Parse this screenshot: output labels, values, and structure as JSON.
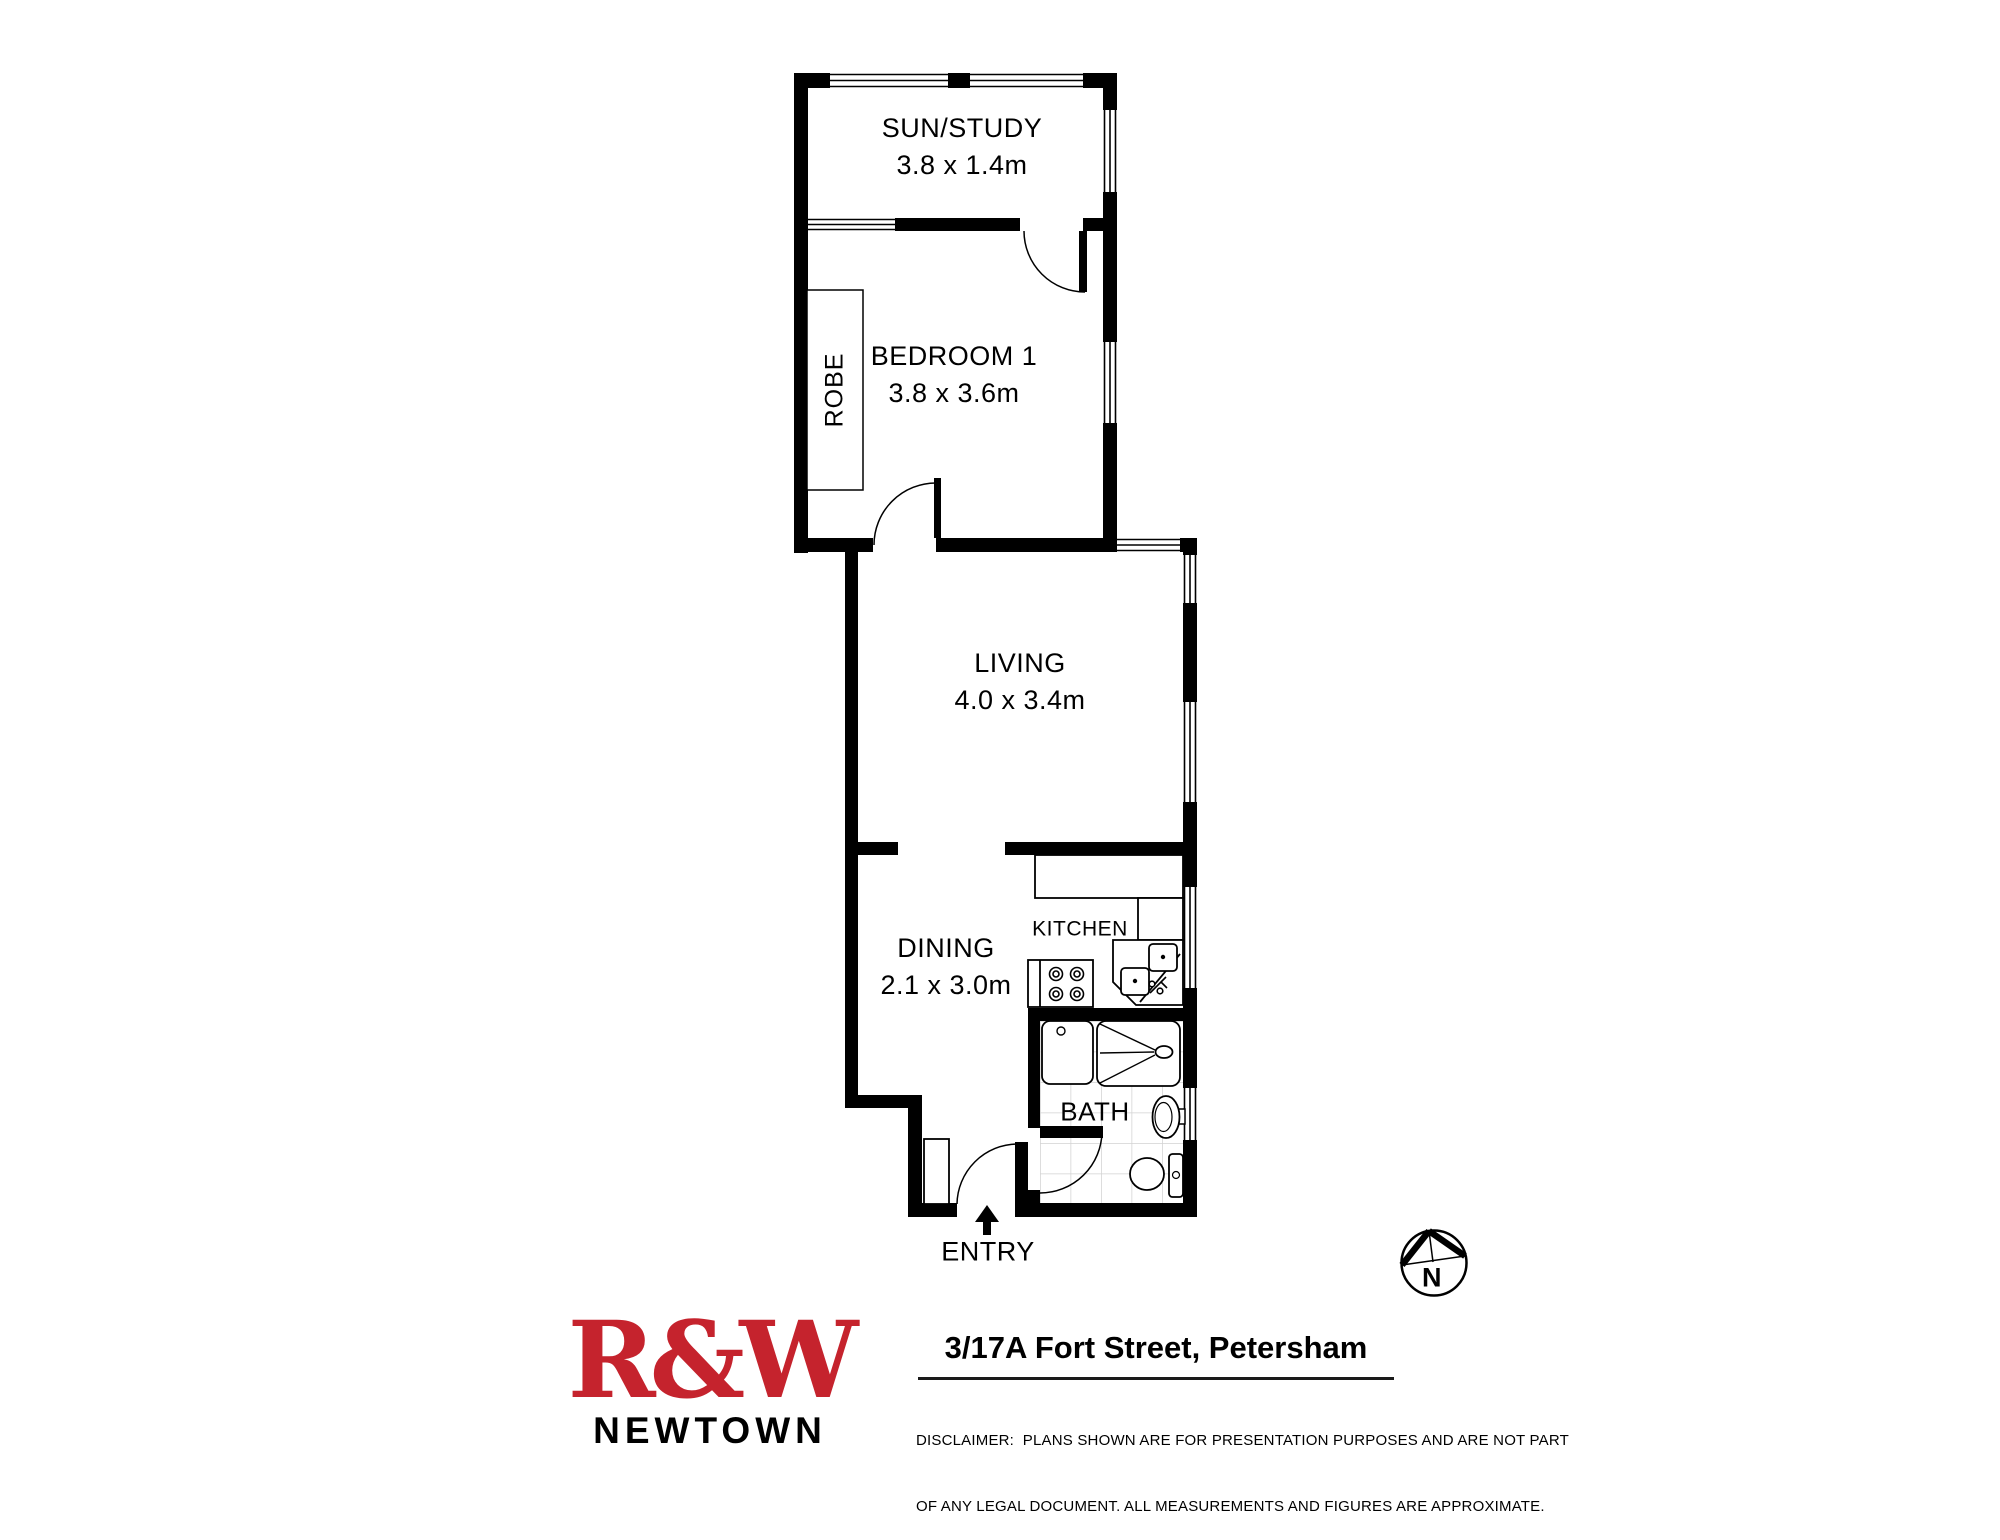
{
  "floorplan": {
    "rooms": [
      {
        "id": "sun-study",
        "name": "SUN/STUDY",
        "dimensions": "3.8 x 1.4m"
      },
      {
        "id": "bedroom-1",
        "name": "BEDROOM 1",
        "dimensions": "3.8 x 3.6m"
      },
      {
        "id": "robe",
        "name": "ROBE"
      },
      {
        "id": "living",
        "name": "LIVING",
        "dimensions": "4.0 x 3.4m"
      },
      {
        "id": "dining",
        "name": "DINING",
        "dimensions": "2.1 x 3.0m"
      },
      {
        "id": "kitchen",
        "name": "KITCHEN"
      },
      {
        "id": "bath",
        "name": "BATH"
      },
      {
        "id": "entry",
        "name": "ENTRY"
      }
    ],
    "compass": {
      "label": "N"
    }
  },
  "footer": {
    "agency": {
      "logo": "R&W",
      "branch": "NEWTOWN",
      "brand_color": "#C5232D"
    },
    "address": "3/17A Fort Street, Petersham",
    "disclaimer_line1": "DISCLAIMER:  PLANS SHOWN ARE FOR PRESENTATION PURPOSES AND ARE NOT PART",
    "disclaimer_line2": "OF ANY LEGAL DOCUMENT. ALL MEASUREMENTS AND FIGURES ARE APPROXIMATE."
  }
}
